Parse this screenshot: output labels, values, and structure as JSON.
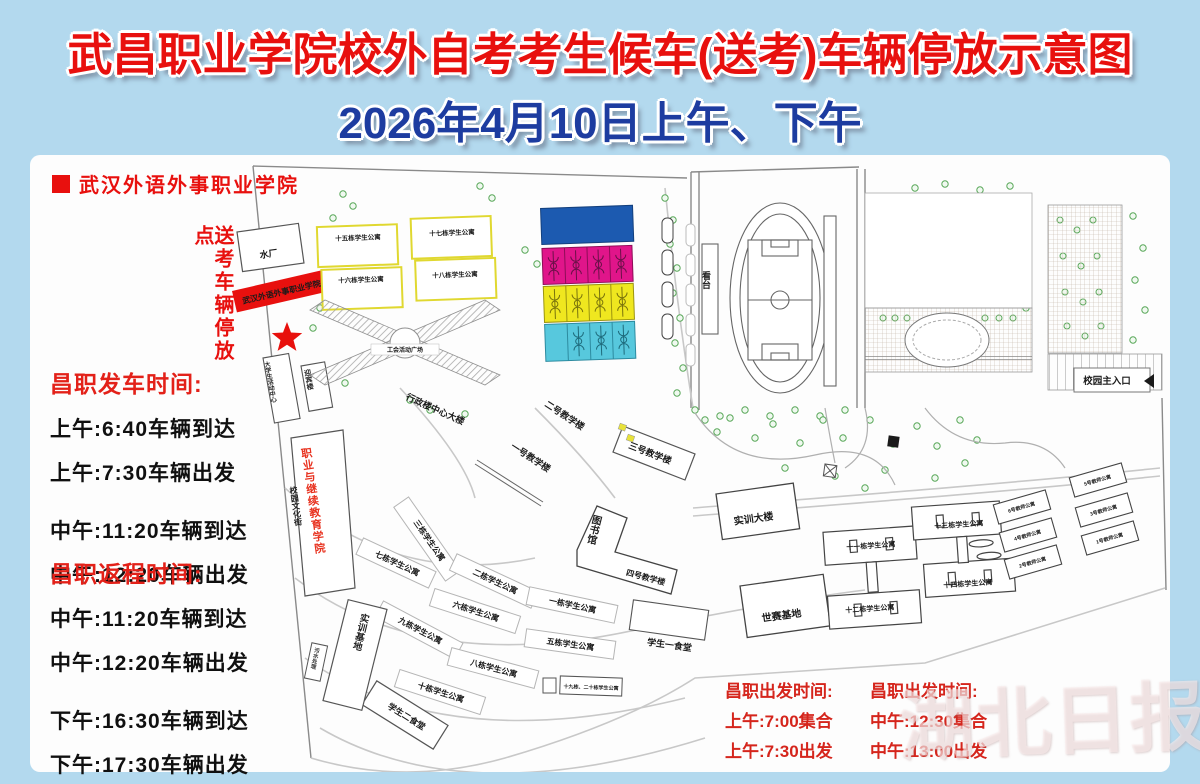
{
  "title": {
    "line1": "武昌职业学院校外自考考生候车(送考)车辆停放示意图",
    "line2": "2026年4月10日上午、下午"
  },
  "legend": {
    "school_name": "武汉外语外事职业学院",
    "parking_point_note": "送考车辆停放点"
  },
  "left_schedules": {
    "depart": {
      "title": "昌职发车时间:",
      "lines": [
        "上午:6:40车辆到达",
        "上午:7:30车辆出发",
        "中午:11:20车辆到达",
        "中午:12:20车辆出发"
      ]
    },
    "return": {
      "title": "昌职返程时间:",
      "lines": [
        "中午:11:20车辆到达",
        "中午:12:20车辆出发",
        "下午:16:30车辆到达",
        "下午:17:30车辆出发"
      ]
    }
  },
  "bottom_schedules": {
    "morning": {
      "title": "昌职出发时间:",
      "lines": [
        "上午:7:00集合",
        "上午:7:30出发"
      ]
    },
    "noon": {
      "title": "昌职出发时间:",
      "lines": [
        "中午:12:30集合",
        "中午:13:00出发"
      ]
    }
  },
  "map": {
    "banner": "武汉外语外事职业学院",
    "buildings": {
      "water_plant": "水厂",
      "activity_center": "大学生活动中心",
      "yingbin": "迎宾楼",
      "vocational_college": "职业与继续教育学院",
      "culture_street": "校园文化街",
      "dorm15": "十五栋学生公寓",
      "dorm16": "十六栋学生公寓",
      "dorm17": "十七栋学生公寓",
      "dorm18": "十八栋学生公寓",
      "plaza": "工会活动广场",
      "admin": "行政楼中心大楼",
      "teach1": "一号教学楼",
      "teach2": "二号教学楼",
      "teach3": "三号教学楼",
      "teach4": "四号教学楼",
      "library": "图书馆",
      "grandstand": "看台",
      "dorm1": "一栋学生公寓",
      "dorm2": "二栋学生公寓",
      "dorm3": "三栋学生公寓",
      "dorm5": "五栋学生公寓",
      "dorm6": "六栋学生公寓",
      "dorm7": "七栋学生公寓",
      "dorm8": "八栋学生公寓",
      "dorm9": "九栋学生公寓",
      "dorm10": "十栋学生公寓",
      "dorm19_20": "十九栋、二十栋学生公寓",
      "canteen1": "学生一食堂",
      "canteen2": "学生二食堂",
      "training_base": "实训基地",
      "sewage": "污水处理",
      "training_building": "实训大楼",
      "worldskills_base": "世赛基地",
      "dorm11": "十一栋学生公寓",
      "dorm12": "十二栋学生公寓",
      "dorm13": "十三栋学生公寓",
      "dorm14": "十四栋学生公寓",
      "teacher1": "1号教师公寓",
      "teacher2": "2号教师公寓",
      "teacher3": "3号教师公寓",
      "teacher4": "4号教师公寓",
      "teacher5": "5号教师公寓",
      "teacher6": "6号教师公寓",
      "main_entrance": "校园主入口"
    }
  },
  "watermark": "湖北日报",
  "colors": {
    "background": "#b3d9ee",
    "title_red": "#e8100e",
    "title_blue": "#1d3ca0",
    "schedule_red": "#e32119",
    "banner_red": "#e8100e",
    "court_blue": "#1c5ab0",
    "court_magenta": "#e0158a",
    "court_yellow": "#efe71f",
    "court_cyan": "#57c8dd",
    "dorm_outline_yellow": "#e8e23c",
    "tree_green": "#5aa85a"
  }
}
